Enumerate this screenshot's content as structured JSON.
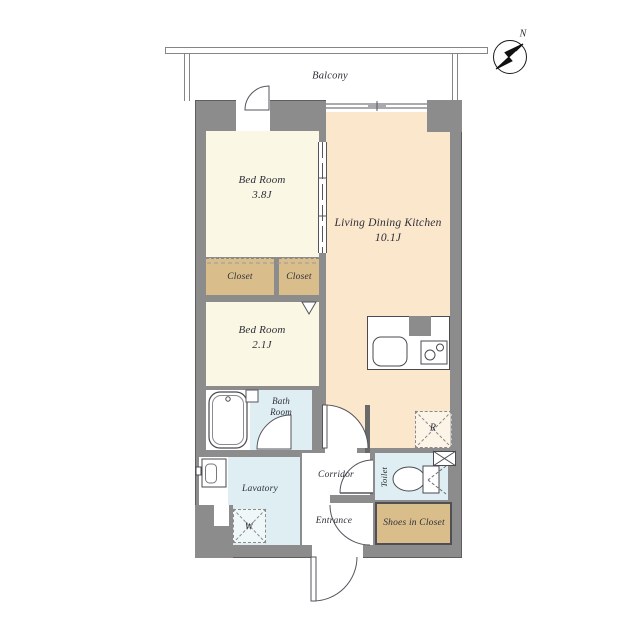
{
  "compass": {
    "north_label": "N"
  },
  "balcony": {
    "label": "Balcony"
  },
  "rooms": {
    "bedroom_1": {
      "name": "Bed Room",
      "area": "3.8J"
    },
    "ldk": {
      "name": "Living Dining Kitchen",
      "area": "10.1J"
    },
    "bedroom_2": {
      "name": "Bed Room",
      "area": "2.1J"
    },
    "closet_left": {
      "name": "Closet"
    },
    "closet_right": {
      "name": "Closet"
    },
    "bathroom": {
      "name_line1": "Bath",
      "name_line2": "Room"
    },
    "lavatory": {
      "name": "Lavatory"
    },
    "corridor": {
      "name": "Corridor"
    },
    "toilet": {
      "name": "Toilet"
    },
    "entrance": {
      "name": "Entrance"
    },
    "shoes_in_closet": {
      "name": "Shoes in Closet"
    }
  },
  "appliance_markers": {
    "washing_machine": "W",
    "refrigerator": "R"
  },
  "colors": {
    "wall": "#8C8C8C",
    "bedroom_floor": "#FAF7E4",
    "ldk_floor": "#FBE7CC",
    "closet_floor": "#D9BE8C",
    "wet_area_floor": "#DEEEF2",
    "line": "#55555c",
    "text": "#2e2e38"
  }
}
